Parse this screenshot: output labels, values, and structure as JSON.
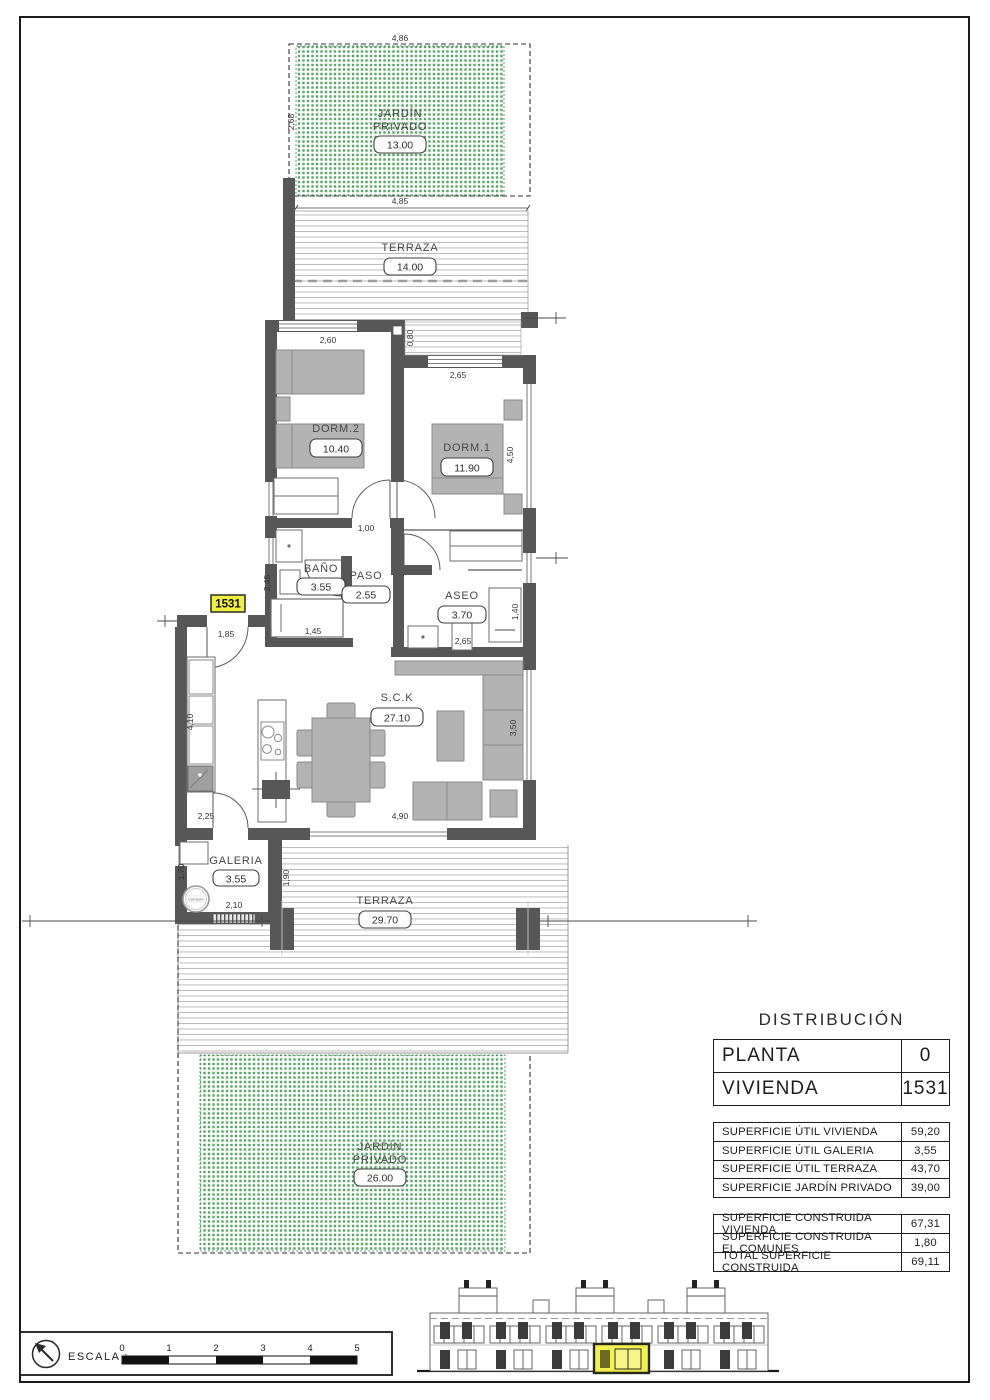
{
  "plan": {
    "unit_badge": "1531",
    "rooms": {
      "garden_top": {
        "line1": "JARDÍN",
        "line2": "PRIVADO",
        "area": "13.00"
      },
      "terraza_top": {
        "name": "TERRAZA",
        "area": "14.00"
      },
      "dorm2": {
        "name": "DORM.2",
        "area": "10.40"
      },
      "dorm1": {
        "name": "DORM.1",
        "area": "11.90"
      },
      "bano": {
        "name": "BAÑO",
        "area": "3.55"
      },
      "paso": {
        "name": "PASO",
        "area": "2.55"
      },
      "aseo": {
        "name": "ASEO",
        "area": "3.70"
      },
      "sck": {
        "name": "S.C.K",
        "area": "27.10"
      },
      "galeria": {
        "name": "GALERIA",
        "area": "3.55",
        "heater": "Calentador"
      },
      "terraza_bottom": {
        "name": "TERRAZA",
        "area": "29.70"
      },
      "garden_bottom": {
        "line1": "JARDÍN",
        "line2": "PRIVADO",
        "area": "26.00"
      }
    },
    "dims": {
      "garden_top_width": "4,86",
      "garden_top_height": "2,68",
      "terraza_top_width": "4,85",
      "dorm2_width": "2,60",
      "strip_depth": "0,80",
      "dorm1_width": "2,65",
      "dorm1_height": "4,50",
      "paso_width": "1,00",
      "bano_height": "2,45",
      "bath_length": "1,45",
      "aseo_width": "2,65",
      "aseo_height": "1,40",
      "entry_width": "1,85",
      "kitchen_height": "4,10",
      "kitchen_width": "2,25",
      "living_width": "4,90",
      "living_height": "3,50",
      "galeria_height": "1,70",
      "galeria_width": "2,10",
      "galeria_right": "1,90"
    }
  },
  "panel": {
    "title": "DISTRIBUCIÓN",
    "id_rows": [
      {
        "label": "PLANTA",
        "value": "0"
      },
      {
        "label": "VIVIENDA",
        "value": "1531"
      }
    ],
    "util_rows": [
      {
        "label": "SUPERFICIE ÚTIL VIVIENDA",
        "value": "59,20"
      },
      {
        "label": "SUPERFICIE ÚTIL GALERIA",
        "value": "3,55"
      },
      {
        "label": "SUPERFICIE ÚTIL TERRAZA",
        "value": "43,70"
      },
      {
        "label": "SUPERFICIE JARDÍN PRIVADO",
        "value": "39,00"
      }
    ],
    "built_rows": [
      {
        "label": "SUPERFICIE CONSTRUIDA VIVIENDA",
        "value": "67,31"
      },
      {
        "label": "SUPERFICIE CONSTRUIDA EL.COMUNES",
        "value": "1,80"
      },
      {
        "label": "TOTAL SUPERFICIE CONSTRUIDA",
        "value": "69,11"
      }
    ]
  },
  "footer": {
    "escala_label": "ESCALA :",
    "ticks": [
      "0",
      "1",
      "2",
      "3",
      "4",
      "5"
    ]
  },
  "colors": {
    "wall_gray": "#575757",
    "garden_green": "#5aa468",
    "highlight_yellow": "#f2ee3f"
  }
}
